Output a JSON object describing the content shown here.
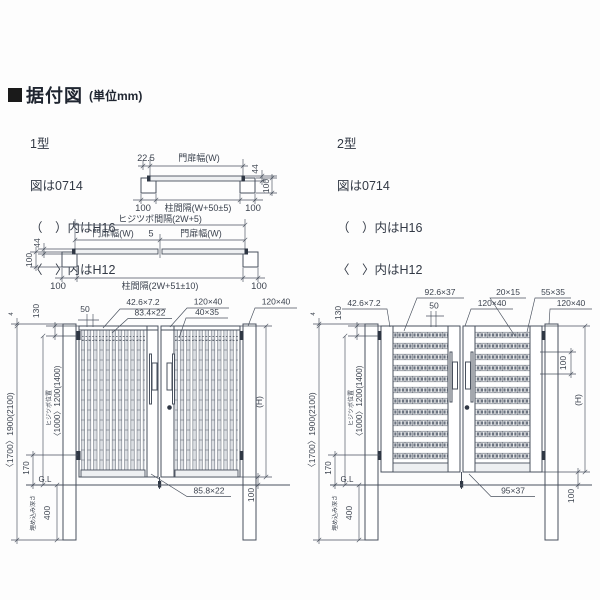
{
  "header": {
    "title": "据付図",
    "unit": "(単位mm)"
  },
  "type1": {
    "name": "1型",
    "fig": "図は0714",
    "note_h16": "（　）内はH16",
    "note_h12": "〈　〉内はH12"
  },
  "type2": {
    "name": "2型",
    "fig": "図は0714",
    "note_h16": "（　）内はH16",
    "note_h12": "〈　〉内はH12"
  },
  "plan1": {
    "hinge_offset": "22.5",
    "gate_width": "門扉幅(W)",
    "gate_depth": "44",
    "post_depth": "100",
    "post_left": "100",
    "post_spacing": "柱間隔(W+50±5)",
    "post_right": "100"
  },
  "plan2": {
    "hinge_spacing": "ヒジツボ間隔(2W+5)",
    "gate_width_left": "門扉幅(W)",
    "center_gap": "5",
    "gate_width_right": "門扉幅(W)",
    "gate_depth": "44",
    "post_depth": "100",
    "post_left": "100",
    "post_spacing": "柱間隔(2W+51±10)",
    "post_right": "100"
  },
  "elev1": {
    "dim_top_gap": "50",
    "slat_size": "42.6×7.2",
    "slat_wide": "83.4×22",
    "stile_size": "120×40",
    "rail_size": "40×35",
    "post_size": "120×40",
    "cap": "4",
    "overall_height": "〈1700〉1900(2100)",
    "top_to_hinge": "130",
    "hinge_label": "ヒジツボ位置",
    "hinge_span": "〈1000〉1200(1400)",
    "hinge_to_gl": "170",
    "ground_line": "G.L",
    "embed_label": "埋め込み深さ",
    "embed_depth": "400",
    "bottom_rail": "85.8×22",
    "gate_height": "(H)",
    "ground_clearance": "100"
  },
  "elev2": {
    "edge_size": "42.6×7.2",
    "slat_size": "92.6×37",
    "dim_top_gap": "50",
    "punch_size": "20×15",
    "rail_size": "55×35",
    "stile_size": "120×40",
    "post_size": "120×40",
    "cap": "4",
    "overall_height": "〈1700〉1900(2100)",
    "top_to_hinge": "130",
    "hinge_label": "ヒジツボ位置",
    "hinge_span": "〈1000〉1200(1400)",
    "hinge_to_gl": "170",
    "ground_line": "G.L",
    "embed_label": "埋め込み深さ",
    "embed_depth": "400",
    "slat_pitch": "100",
    "bottom_rail": "95×37",
    "gate_height": "(H)",
    "ground_clearance": "100"
  },
  "colors": {
    "line": "#49515e",
    "text": "#3c434f",
    "slat_fill": "#dcdfe3",
    "marker": "#1a1a1a"
  }
}
